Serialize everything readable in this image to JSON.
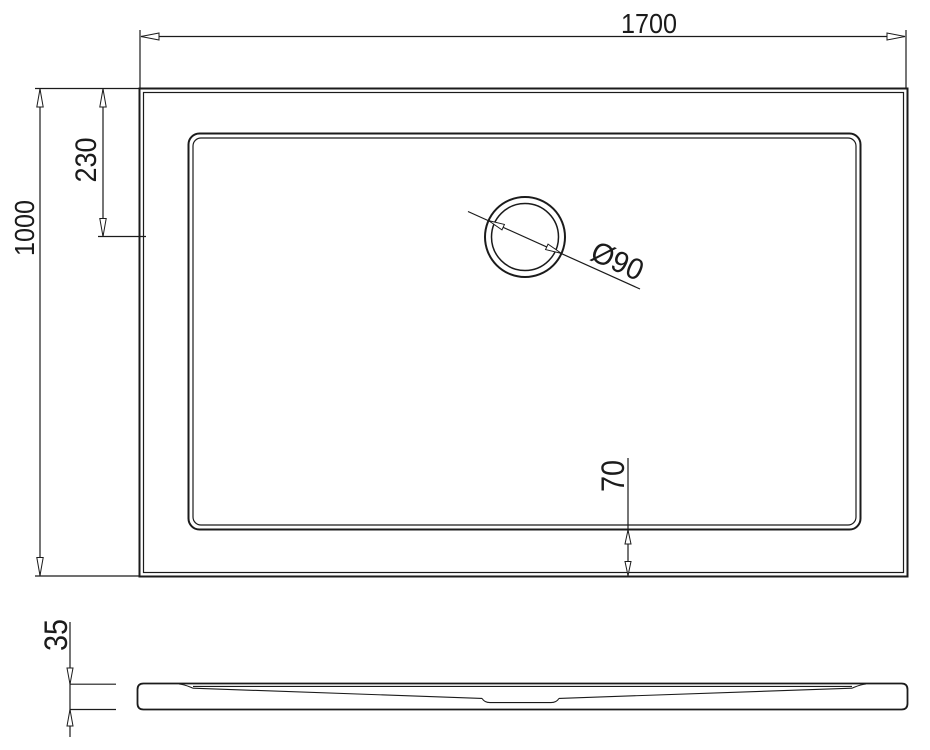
{
  "drawing": {
    "plan_view": {
      "width_dim": "1700",
      "depth_dim": "1000",
      "drain_center_from_top_dim": "230",
      "floor_to_edge_bottom_dim": "70",
      "drain_diameter_dim": "Ø90"
    },
    "profile_view": {
      "height_dim": "35"
    },
    "line_color": "#1b1b1b",
    "background_color": "#ffffff"
  }
}
